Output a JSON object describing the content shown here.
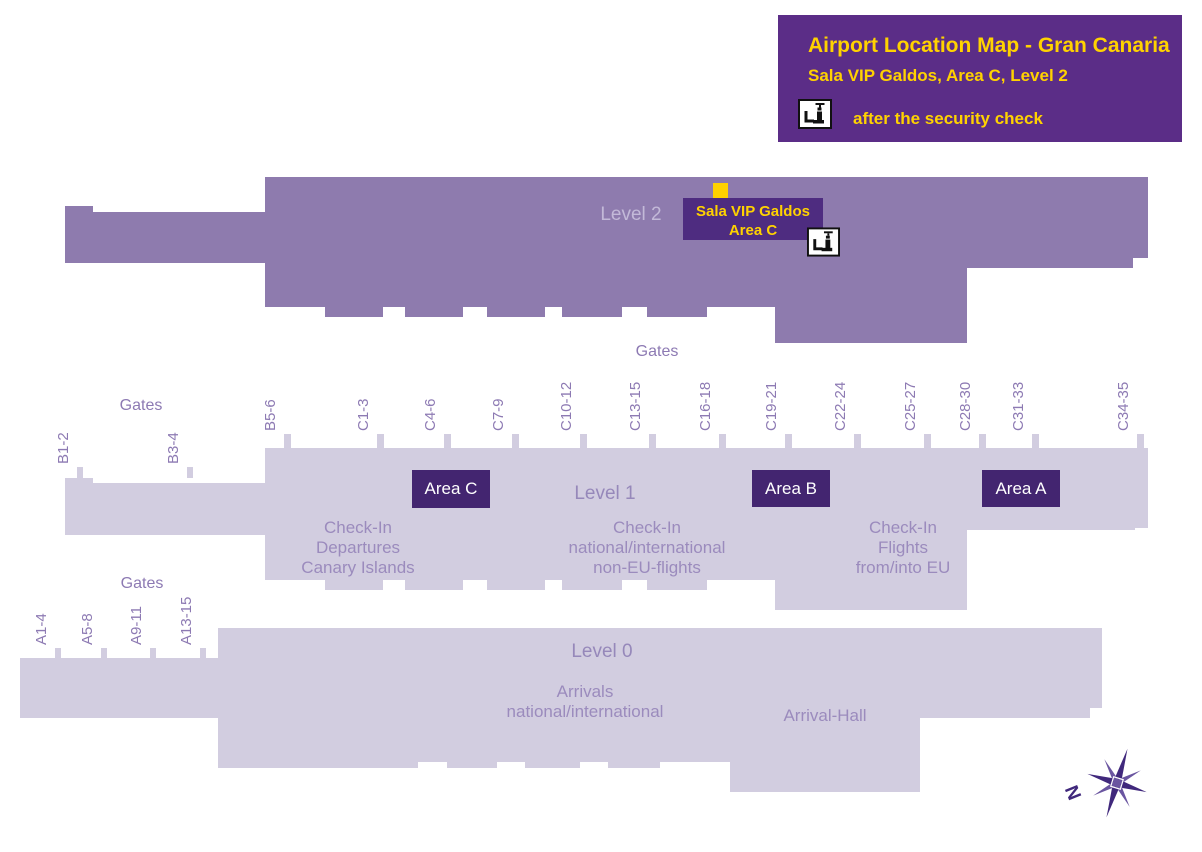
{
  "title_box": {
    "title": "Airport Location Map - Gran Canaria",
    "subtitle": "Sala VIP Galdos, Area C, Level 2",
    "note": "after the security check"
  },
  "colors": {
    "header_bg": "#5b2d87",
    "accent_yellow": "#ffd200",
    "level2_fill": "#8e7bae",
    "level01_fill": "#d2cde0",
    "area_box_bg": "#432570",
    "vip_box_bg": "#4e2c80",
    "gate_label_purple": "#8d7ab3",
    "section_text_purple": "#9b8bbd",
    "compass_purple": "#40287c"
  },
  "icons": {
    "security_check": "security-check-icon",
    "compass": "compass-rose-icon"
  },
  "level2": {
    "label": "Level 2",
    "vip_label_line1": "Sala VIP Galdos",
    "vip_label_line2": "Area C"
  },
  "level1": {
    "label": "Level 1",
    "gates_title_top": "Gates",
    "gates_title_left": "Gates",
    "left_gates": [
      "B1-2",
      "B3-4"
    ],
    "gates": [
      "B5-6",
      "C1-3",
      "C4-6",
      "C7-9",
      "C10-12",
      "C13-15",
      "C16-18",
      "C19-21",
      "C22-24",
      "C25-27",
      "C28-30",
      "C31-33",
      "C34-35"
    ],
    "areas": [
      {
        "label": "Area C"
      },
      {
        "label": "Area B"
      },
      {
        "label": "Area A"
      }
    ],
    "sections": [
      {
        "lines": [
          "Check-In",
          "Departures",
          "Canary Islands"
        ]
      },
      {
        "lines": [
          "Check-In",
          "national/international",
          "non-EU-flights"
        ]
      },
      {
        "lines": [
          "Check-In",
          "Flights",
          "from/into EU"
        ]
      }
    ]
  },
  "level0": {
    "label": "Level 0",
    "gates_title": "Gates",
    "gates": [
      "A1-4",
      "A5-8",
      "A9-11",
      "A13-15"
    ],
    "sections": [
      {
        "lines": [
          "Arrivals",
          "national/international"
        ]
      },
      {
        "lines": [
          "Arrival-Hall"
        ]
      }
    ]
  },
  "compass": {
    "label": "N"
  }
}
